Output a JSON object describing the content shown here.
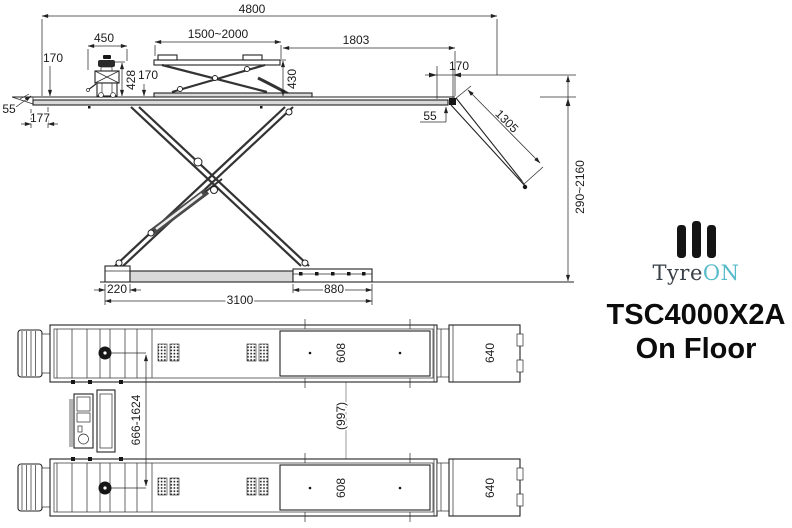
{
  "product": {
    "brand_prefix": "Tyre",
    "brand_suffix": "ON",
    "model": "TSC4000X2A",
    "variant": "On Floor"
  },
  "colors": {
    "accent_teal": "#58bbca",
    "line_ink": "#222222"
  },
  "side_view": {
    "total_length": "4800",
    "power_unit_width": "450",
    "lifting_table_range": "1500~2000",
    "platform_rear_section": "1803",
    "platform_height_left": "170",
    "power_unit_height": "428",
    "platform_height_mid": "170",
    "lifting_table_height": "430",
    "platform_height_right": "170",
    "edge_left": "55",
    "tip_length": "177",
    "edge_right": "55",
    "ramp_length": "1305",
    "lift_height_range": "290~2160",
    "base_foot_width": "220",
    "base_length": "3100",
    "base_extension": "880"
  },
  "plan_view": {
    "platform_width_front": "608",
    "platform_width_rear": "608",
    "ramp_width_front": "640",
    "ramp_width_rear": "640",
    "track_distance": "(997)",
    "adjust_range": "666-1624"
  }
}
